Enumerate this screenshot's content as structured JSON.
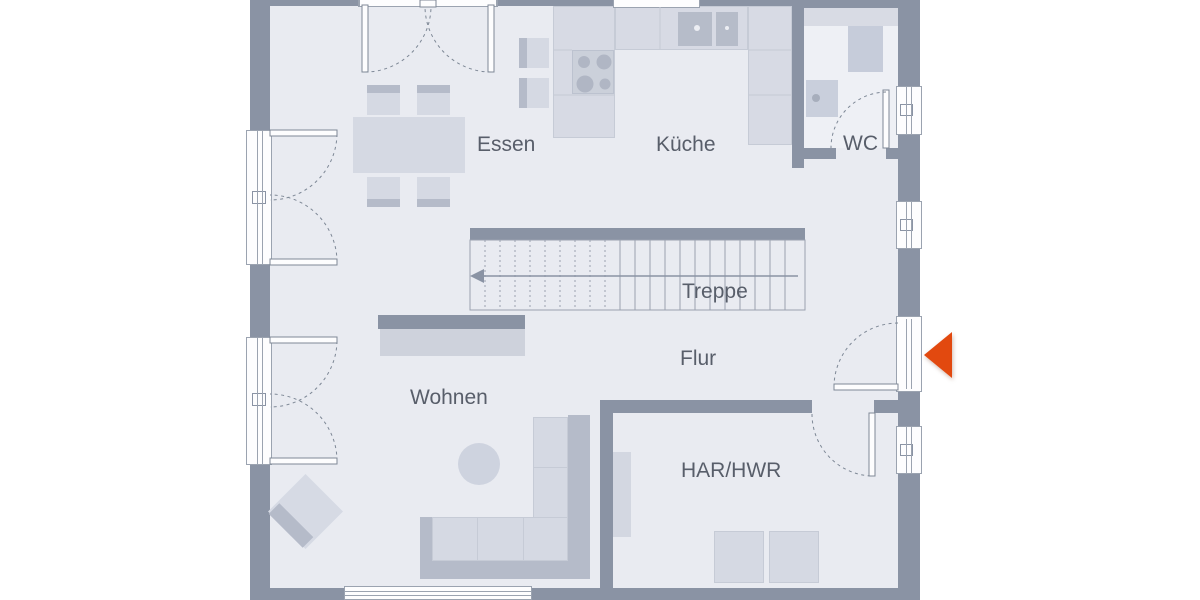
{
  "plan": {
    "labels": {
      "essen": "Essen",
      "kueche": "Küche",
      "wc": "WC",
      "treppe": "Treppe",
      "flur": "Flur",
      "wohnen": "Wohnen",
      "har_hwr": "HAR/HWR"
    }
  },
  "colors": {
    "wall": "#8a93a4",
    "floor": "#e9ebf1",
    "counter": "#d7dae4",
    "furniture": "#d5d9e3",
    "furniture-shade": "#b5bbc9",
    "accent-arrow": "#e2490f",
    "label-text": "#585e6a"
  }
}
